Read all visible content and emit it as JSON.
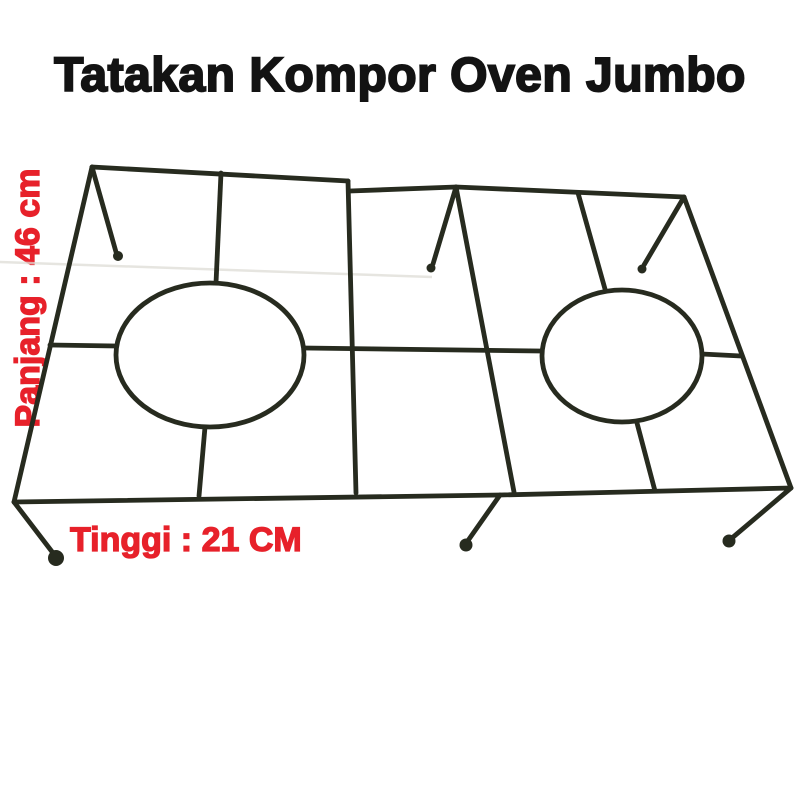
{
  "page": {
    "background_color": "#ffffff"
  },
  "header": {
    "title": "Tatakan Kompor Oven Jumbo",
    "title_color": "#131313"
  },
  "annotations": {
    "length_label": "Panjang : 46 cm",
    "height_label": "Tinggi : 21 CM",
    "label_color": "#e7212a"
  },
  "product": {
    "semantic_name": "double-burner-wire-stove-rack",
    "wire_color": "#272b1f"
  }
}
